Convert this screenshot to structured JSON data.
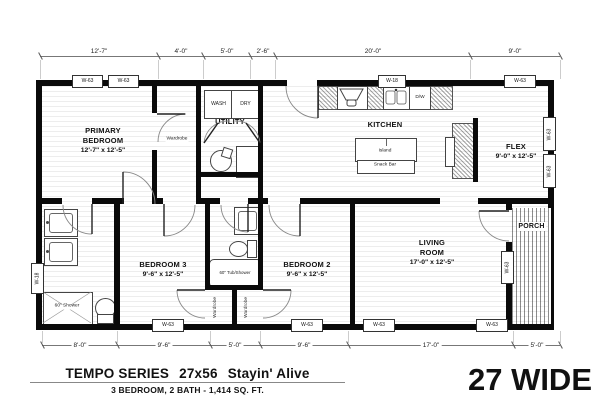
{
  "footer": {
    "series": "TEMPO SERIES",
    "model": "27x56",
    "name": "Stayin' Alive",
    "specs": "3 BEDROOM, 2 BATH - 1,414 SQ. FT.",
    "wide": "27 WIDE"
  },
  "dims": {
    "top": [
      "12'-7\"",
      "4'-0\"",
      "5'-0\"",
      "2'-6\"",
      "20'-0\"",
      "9'-0\""
    ],
    "bottom": [
      "8'-0\"",
      "9'-6\"",
      "5'-0\"",
      "9'-6\"",
      "17'-0\"",
      "5'-0\""
    ]
  },
  "rooms": {
    "primary": {
      "name": "PRIMARY\nBEDROOM",
      "size": "12'-7\" x 12'-5\""
    },
    "utility": {
      "name": "UTILITY"
    },
    "kitchen": {
      "name": "KITCHEN"
    },
    "flex": {
      "name": "FLEX",
      "size": "9'-0\" x 12'-5\""
    },
    "bedroom3": {
      "name": "BEDROOM 3",
      "size": "9'-6\" x 12'-5\""
    },
    "bedroom2": {
      "name": "BEDROOM 2",
      "size": "9'-6\" x 12'-5\""
    },
    "living": {
      "name": "LIVING\nROOM",
      "size": "17'-0\" x 12'-5\""
    },
    "porch": {
      "name": "PORCH"
    }
  },
  "fixtures": {
    "wash": "WASH",
    "dry": "DRY",
    "island": "Island",
    "snack_bar": "Snack Bar",
    "dw": "D/W",
    "wardrobe": "Wardrobe",
    "shower": "60\" Shower",
    "tub": "60\" Tub/Shower"
  },
  "windows": {
    "w63": "W-63",
    "w18": "W-18"
  }
}
